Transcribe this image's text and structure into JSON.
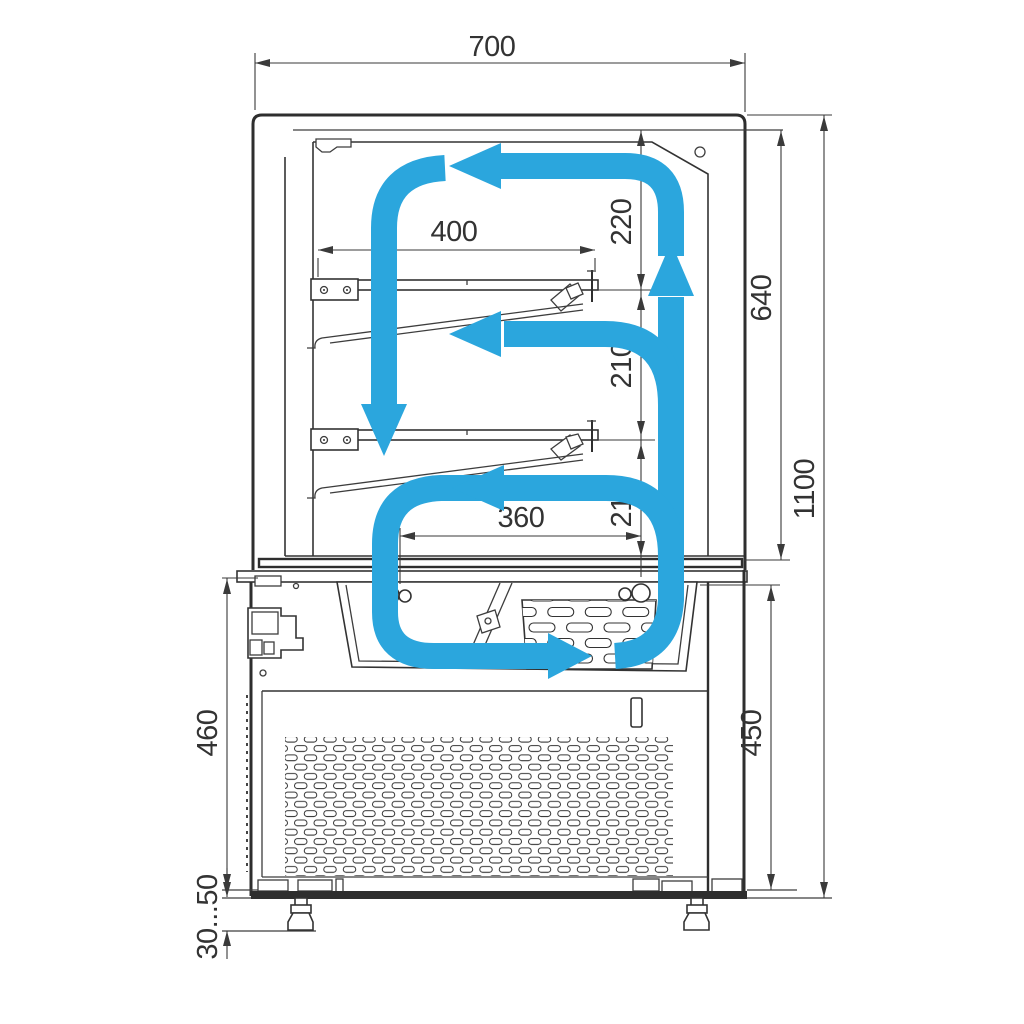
{
  "diagram": {
    "title": "refrigerated-display-case-section",
    "dimensions": {
      "overall_width": "700",
      "overall_height": "1100",
      "display_section_height": "640",
      "base_section_height": "450",
      "lower_body_height": "460",
      "adjustable_foot_height": "30...50",
      "upper_shelf_depth": "400",
      "lower_shelf_depth": "360",
      "top_clearance": "220",
      "middle_clearance": "210",
      "bottom_clearance": "210"
    },
    "colors": {
      "airflow_blue": "#2BA6DD",
      "line_dark": "#3A3A3A"
    }
  }
}
